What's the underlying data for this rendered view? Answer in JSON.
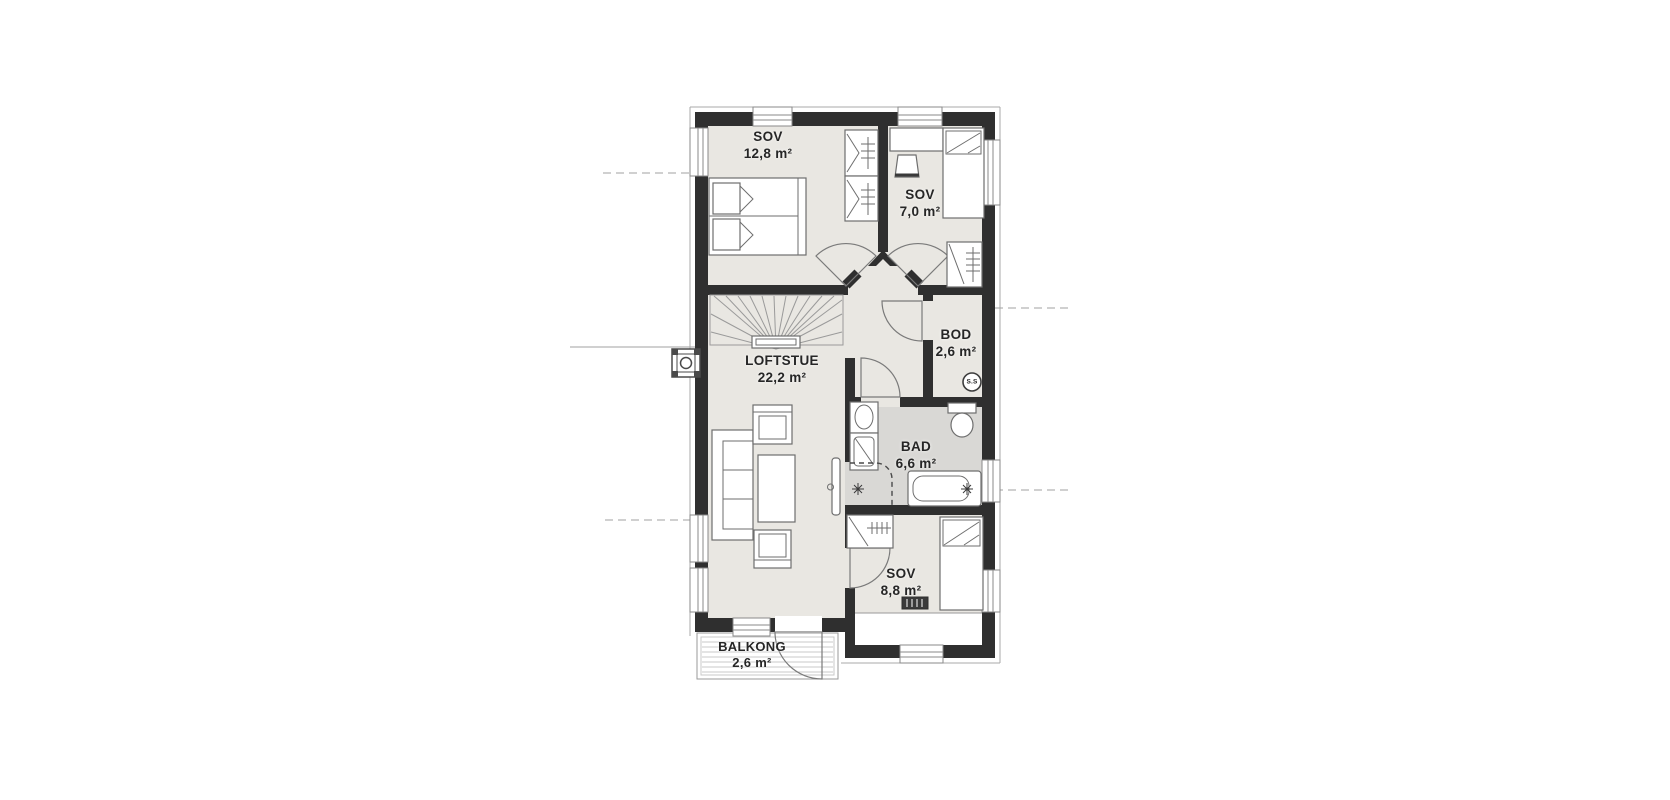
{
  "plan": {
    "type": "floor-plan",
    "rooms": [
      {
        "id": "sov1",
        "name": "SOV",
        "area": "12,8 m²"
      },
      {
        "id": "sov2",
        "name": "SOV",
        "area": "7,0 m²"
      },
      {
        "id": "bod",
        "name": "BOD",
        "area": "2,6 m²"
      },
      {
        "id": "loftstue",
        "name": "LOFTSTUE",
        "area": "22,2 m²"
      },
      {
        "id": "bad",
        "name": "BAD",
        "area": "6,6 m²"
      },
      {
        "id": "sov3",
        "name": "SOV",
        "area": "8,8 m²"
      },
      {
        "id": "balkong",
        "name": "BALKONG",
        "area": "2,6 m²"
      }
    ],
    "badge": {
      "label": "S.S"
    },
    "colors": {
      "wall": "#2f2f2f",
      "floor": "#e9e7e2",
      "bath": "#d9d8d5"
    }
  }
}
